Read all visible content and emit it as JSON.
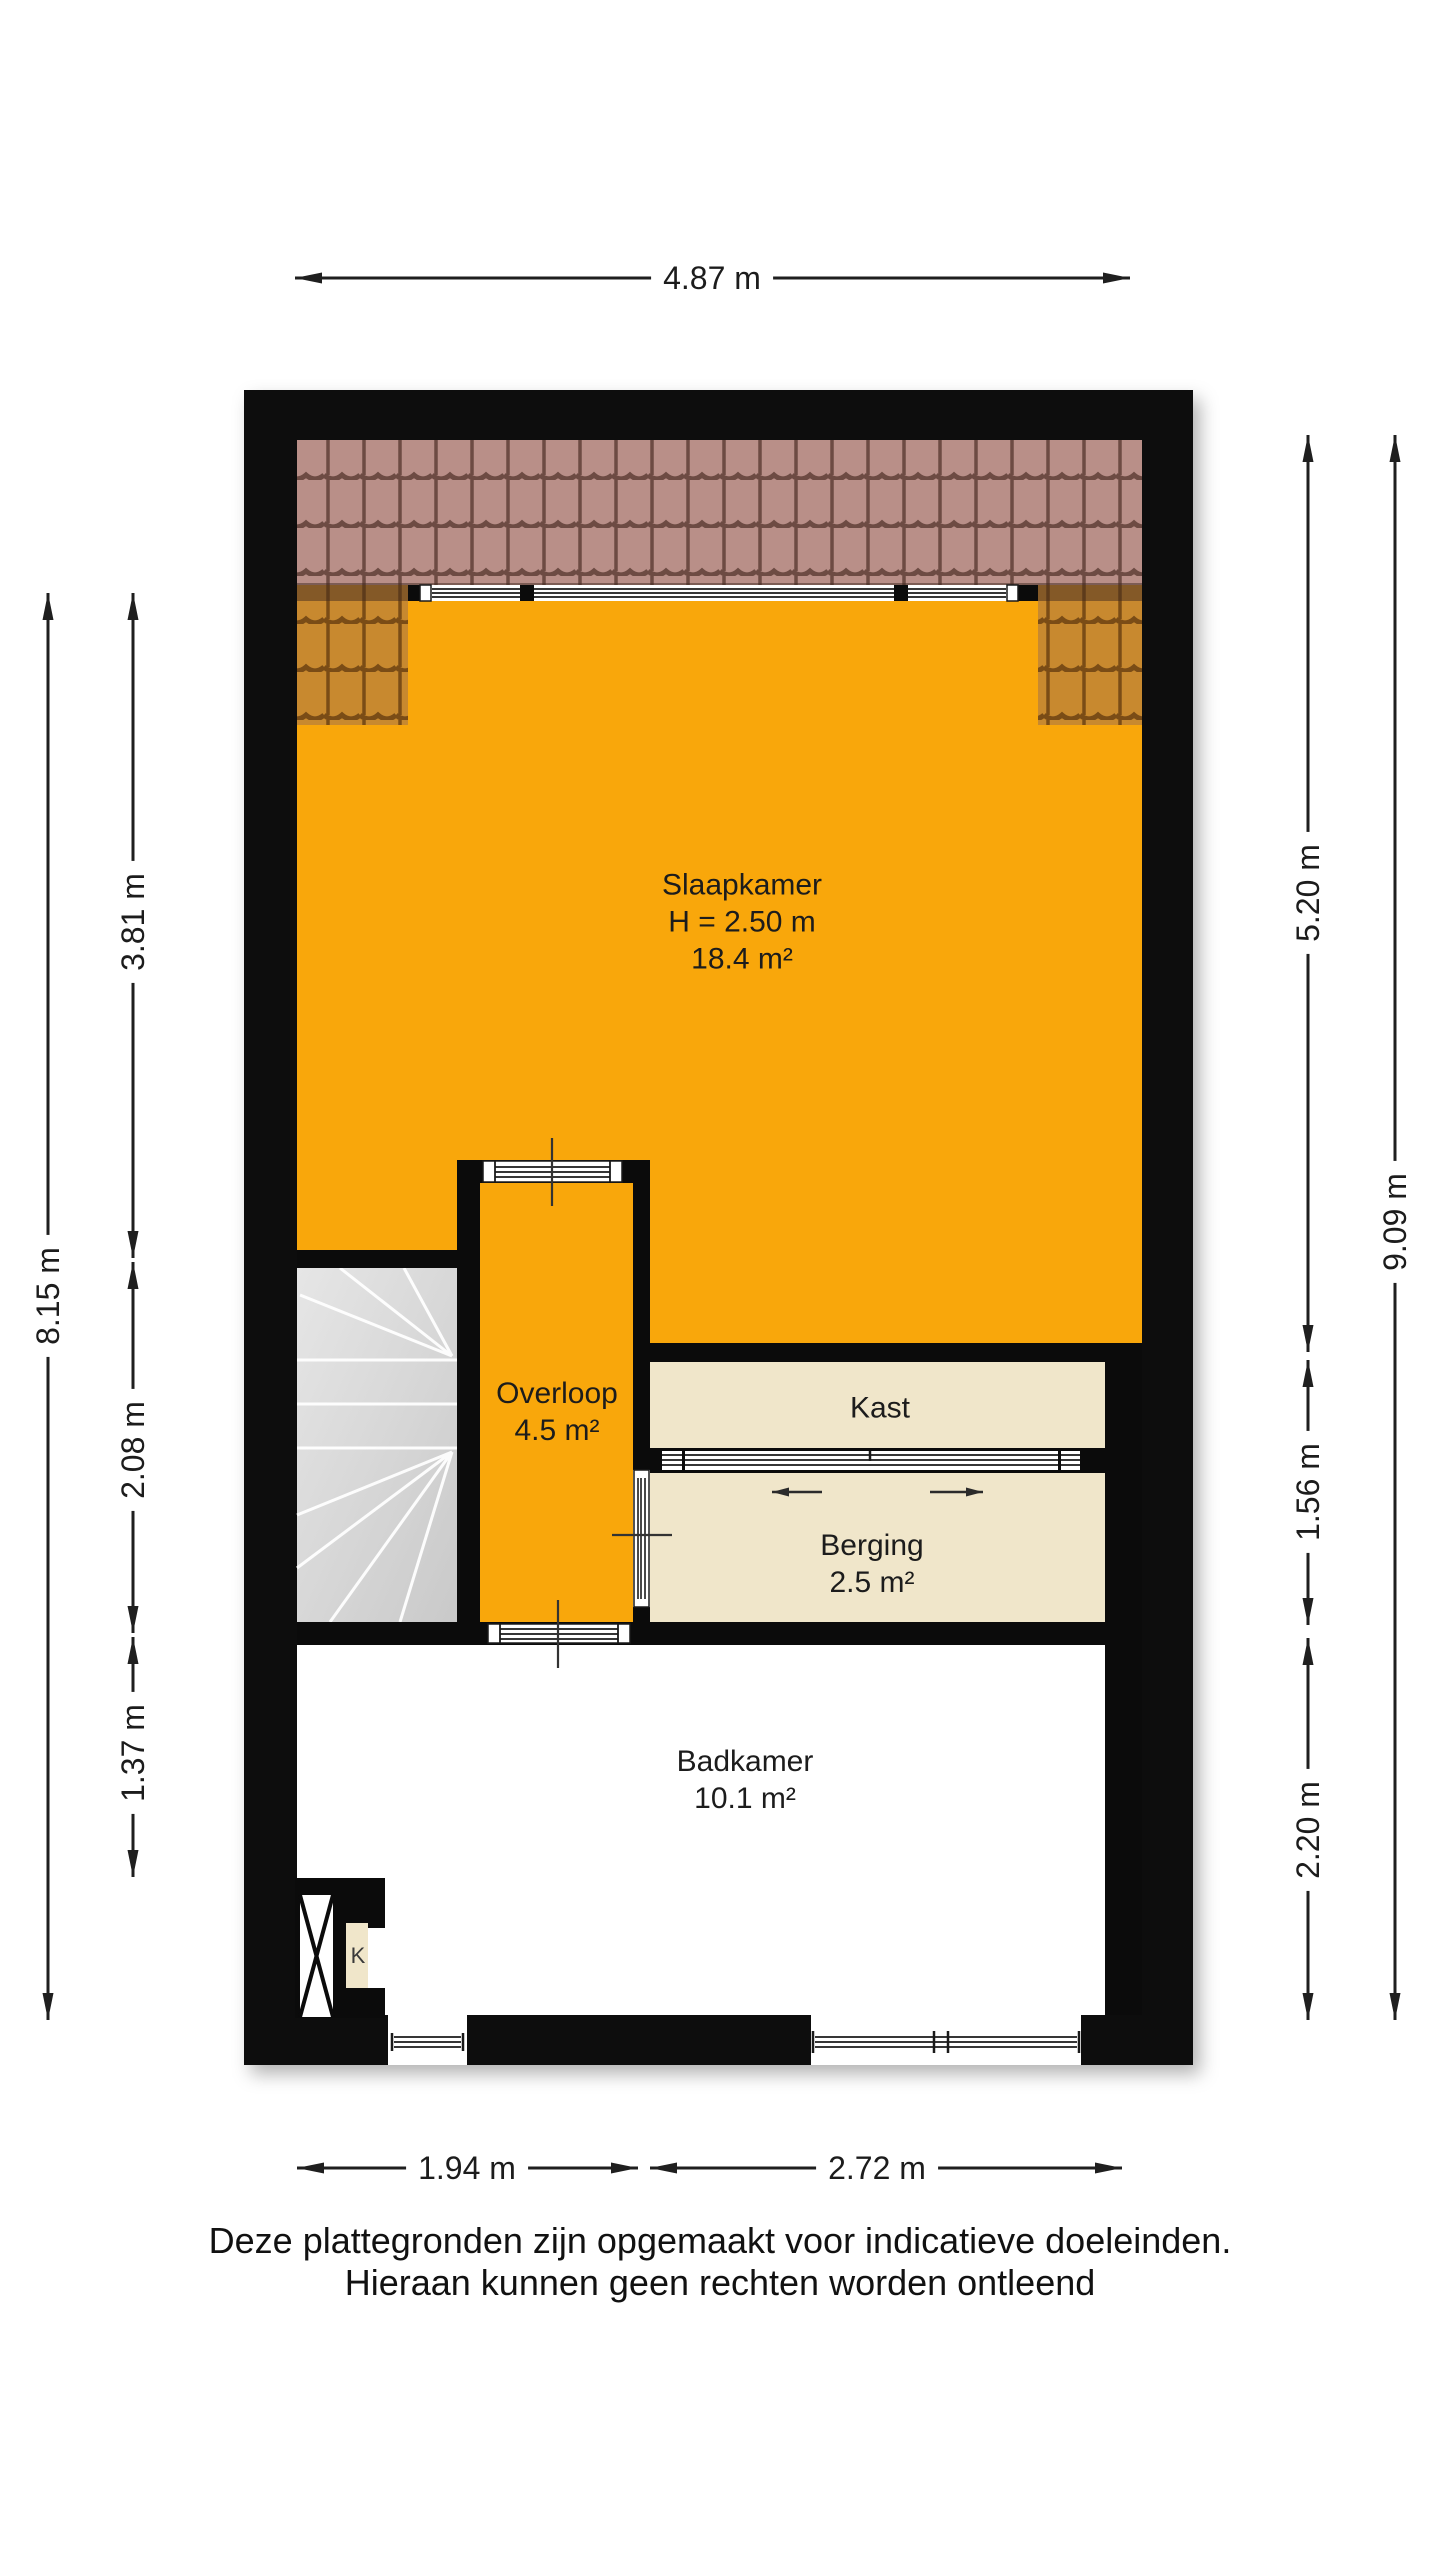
{
  "rooms": {
    "slaapkamer": {
      "name": "Slaapkamer",
      "ceiling_height": "H = 2.50 m",
      "area": "18.4 m²"
    },
    "overloop": {
      "name": "Overloop",
      "area": "4.5 m²"
    },
    "kast": {
      "name": "Kast"
    },
    "berging": {
      "name": "Berging",
      "area": "2.5 m²"
    },
    "badkamer": {
      "name": "Badkamer",
      "area": "10.1 m²"
    },
    "koker": {
      "name": "K"
    }
  },
  "dimensions": {
    "top_width": "4.87 m",
    "left_total": "8.15 m",
    "left_segments": [
      "3.81 m",
      "2.08 m",
      "1.37 m"
    ],
    "right_total": "9.09 m",
    "right_segments": [
      "5.20 m",
      "1.56 m",
      "2.20 m"
    ],
    "bottom_segments": [
      "1.94 m",
      "2.72 m"
    ]
  },
  "disclaimer": {
    "line1": "Deze plattegronden zijn opgemaakt voor indicatieve doeleinden.",
    "line2": "Hieraan kunnen geen rechten worden ontleend"
  },
  "colors": {
    "wall": "#0b0b0b",
    "floor_orange": "#f9a70b",
    "floor_beige": "#f0e6ca",
    "roof_tile_top_base": "#b98f88",
    "roof_tile_top_line": "#6d4b43",
    "roof_tile_side_base": "#c8892f",
    "roof_tile_side_line": "#7a4c16",
    "stairs_grey": "#d6d6d6",
    "dimension_line": "#1f1f1f"
  }
}
